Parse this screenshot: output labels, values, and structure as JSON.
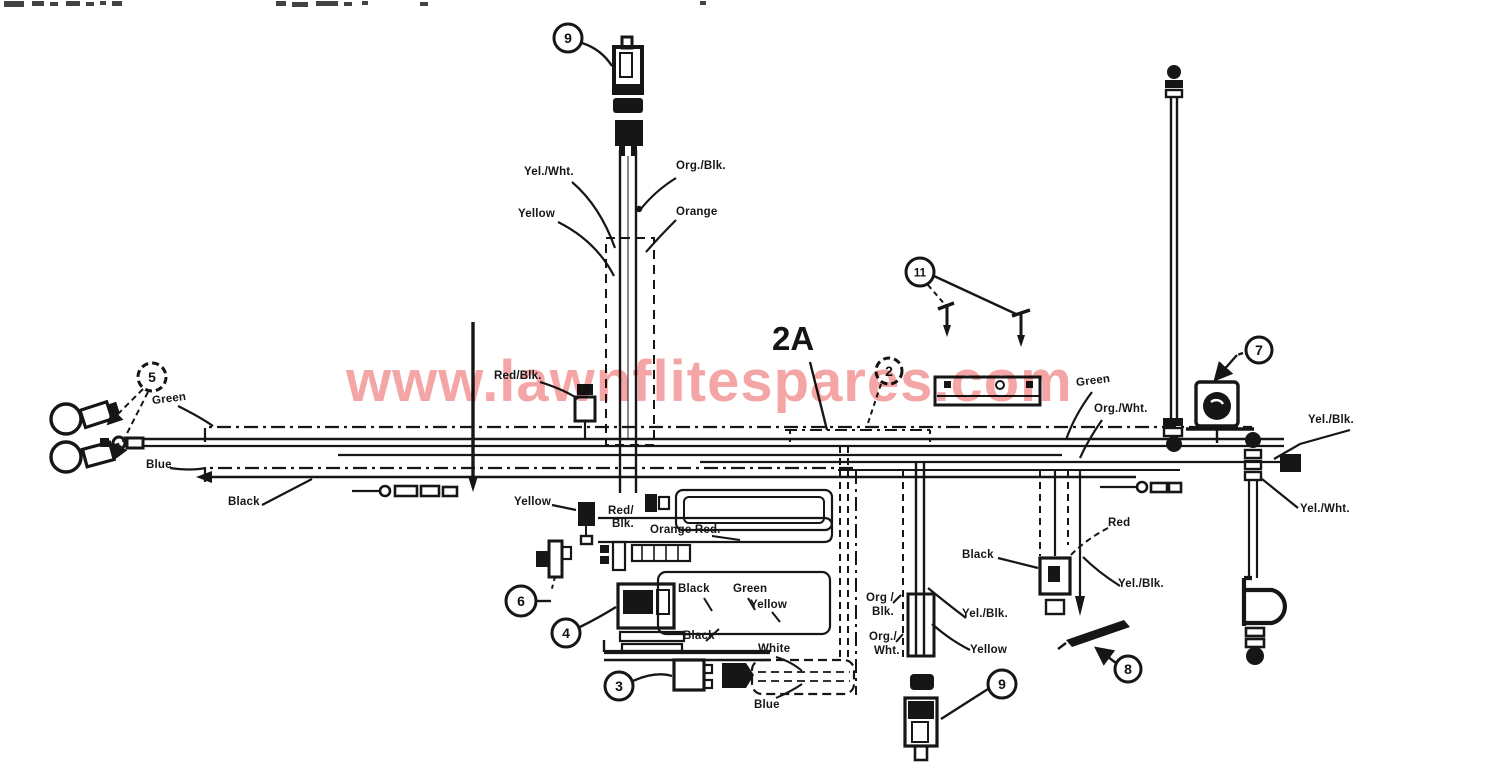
{
  "watermark": {
    "text": "www.lawnflitespares.com",
    "color": "#ee8c8c"
  },
  "section": {
    "label": "2A"
  },
  "callouts": {
    "top_connector": "9",
    "screws": "11",
    "harness": "2",
    "key_switch": "7",
    "headlights": "5",
    "toggle": "6",
    "relay": "4",
    "plug": "3",
    "bottom_connector": "9",
    "strap": "8"
  },
  "wire_labels": {
    "yel_wht_top": "Yel./Wht.",
    "org_blk_top": "Org./Blk.",
    "yellow_top": "Yellow",
    "orange_top": "Orange",
    "red_blk_mid": "Red/Blk.",
    "green_left": "Green",
    "blue_left": "Blue",
    "black_left": "Black",
    "yellow_mid": "Yellow",
    "red_blk_low_1": "Red/",
    "red_blk_low_2": "Blk.",
    "orange_red": "Orange Red.",
    "black_center": "Black",
    "green_center": "Green",
    "yellow_center": "Yellow",
    "black_lower": "Black",
    "white_lower": "White",
    "blue_lower": "Blue",
    "org_blk_bot_1": "Org /",
    "org_blk_bot_2": "Blk.",
    "org_wht_bot_1": "Org./",
    "org_wht_bot_2": "Wht.",
    "yel_blk_bot": "Yel./Blk.",
    "yellow_bot": "Yellow",
    "black_right": "Black",
    "red_right": "Red",
    "yel_blk_right": "Yel./Blk.",
    "green_right": "Green",
    "org_wht_right": "Org./Wht.",
    "yel_blk_far": "Yel./Blk.",
    "yel_wht_far": "Yel./Wht."
  }
}
